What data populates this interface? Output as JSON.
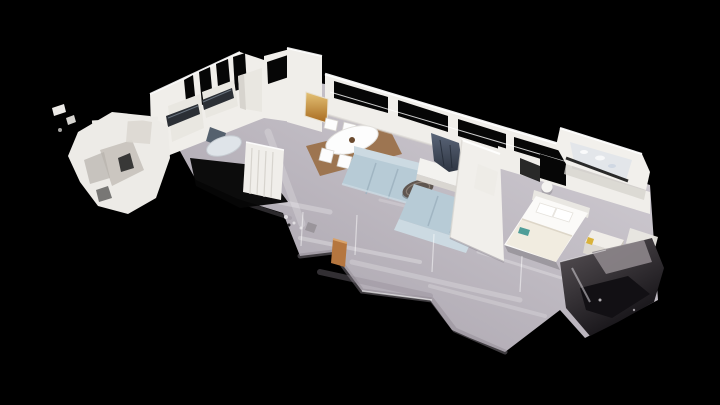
{
  "app": {
    "view_label": "3D dollhouse view of apartment scan"
  },
  "scene": {
    "type": "photogrammetry dollhouse cutaway of a residential apartment",
    "camera": "elevated oblique view, apartment runs diagonally lower-left to upper-right on black void",
    "rooms": [
      {
        "name": "scan-fragment",
        "label": "partial scan fragment (far left)",
        "objects": [
          "broken white mesh planes",
          "thin beam"
        ]
      },
      {
        "name": "kitchen",
        "label": "kitchen",
        "objects": [
          "white cabinetry",
          "two dark countertop runs",
          "dark wardrobe-window slats",
          "small round table",
          "dark chair",
          "white slatted shelf",
          "black scan hole in floor"
        ]
      },
      {
        "name": "hallway",
        "label": "hallway",
        "objects": [
          "tall white wall",
          "amber framed artwork",
          "dark end window"
        ]
      },
      {
        "name": "living-dining",
        "label": "living / dining room",
        "objects": [
          "white oval dining table",
          "six white chairs",
          "brown area rug",
          "two light-blue sofas",
          "round dark coffee table",
          "tv draped dark on white media console",
          "window voids along cut back wall",
          "orange door fragment on floor"
        ]
      },
      {
        "name": "bedroom",
        "label": "bedroom",
        "objects": [
          "white double bed",
          "two pillows",
          "teal object on duvet",
          "white nightstand",
          "yellow speck",
          "round wall sconce",
          "white partition wall"
        ]
      },
      {
        "name": "bathroom",
        "label": "bathroom seen from above through cutaway",
        "objects": [
          "pale mottled floor",
          "dark rail edge"
        ]
      },
      {
        "name": "mesh-chunk",
        "label": "ragged dark mesh chunk (bottom right scan edge)",
        "objects": [
          "glossy dark facets"
        ]
      }
    ]
  },
  "palette": {
    "background": "#000000",
    "floor_dark": "#a39da7",
    "floor_light": "#d7d3d9",
    "floor_streak": "#ffffff",
    "floor_shadow": "#8e8891",
    "wall": "#f0eeea",
    "wall_bright": "#ffffff",
    "wall_shade": "#d7d4ce",
    "window_void": "#060606",
    "counter": "#2b2f35",
    "counter_glint": "#6f7a85",
    "cabinet": "#e9e7e1",
    "chair_dark": "#55616e",
    "small_table": "#dfe4e9",
    "shelf": "#f0eeea",
    "rug": "#9a6f46",
    "dining_set": "#fdfdfd",
    "centerpiece": "#6b4a2e",
    "sofa": "#b7cbd6",
    "sofa_light": "#ccdae2",
    "sofa_line": "#9db2c0",
    "coffee_table": "#5f5650",
    "coffee_table_rim": "#8a7e74",
    "console": "#f3f2ef",
    "console_shade": "#d9d6d1",
    "tv_dark": "#2e3542",
    "tv_light": "#5a6578",
    "tv_fold": "#232a36",
    "partition": "#f1efeb",
    "bed_white": "#fbfaf8",
    "bed_cream": "#efe9dc",
    "headboard": "#e9e7e2",
    "teal_accent": "#4f9d98",
    "nightstand": "#f0ede8",
    "nightstand_shade": "#ddd9d2",
    "nightstand_side": "#c9c4b8",
    "yellow_accent": "#d9b23a",
    "sconce": "#f5f4f1",
    "bath_wall": "#f2f0ec",
    "bath_floor": "#e3e6ea",
    "bath_blue": "#cdd6e2",
    "rail_dark": "#141414",
    "door_fragment": "#b5763f",
    "door_fragment_light": "#d9a36b",
    "mesh_light": "#8d868b",
    "mesh_mid": "#5a5458",
    "mesh_dark": "#121014",
    "artwork_light": "#e4c276",
    "artwork_dark": "#a86a1f",
    "fragment_white": "#edebe7",
    "fragment_shade": "#c6c2bb",
    "debris_gray": "#9a959b"
  }
}
